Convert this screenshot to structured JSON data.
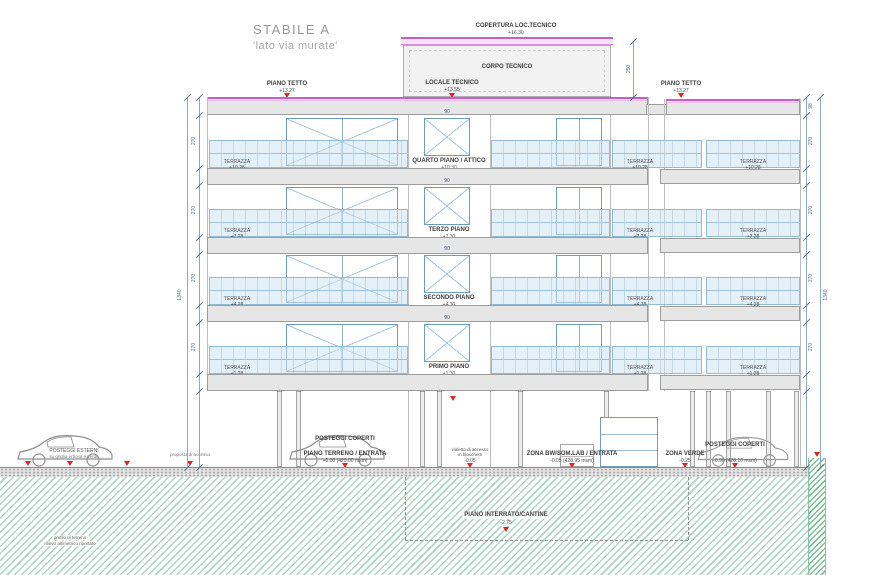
{
  "title": {
    "main": "STABILE A",
    "subtitle": "'lato via murate'"
  },
  "roof": {
    "copertura_label": "COPERTURA LOC.TECNICO",
    "copertura_elev": "+16.30",
    "corpo_tecnico_label": "CORPO TECNICO",
    "locale_tecnico_label": "LOCALE TECNICO",
    "locale_tecnico_elev": "+13.55",
    "piano_tetto_label": "PIANO TETTO",
    "piano_tetto_elev": "+13.27"
  },
  "terrazza_label": "TERRAZZA",
  "floors": [
    {
      "name": "QUARTO PIANO / ATTICO",
      "elev": "+10.30",
      "terrazza_elev": "+10.28"
    },
    {
      "name": "TERZO PIANO",
      "elev": "+7.30",
      "terrazza_elev": "+7.28"
    },
    {
      "name": "SECONDO PIANO",
      "elev": "+4.30",
      "terrazza_elev": "+4.28"
    },
    {
      "name": "PRIMO PIANO",
      "elev": "+1.30",
      "terrazza_elev": "+1.28"
    }
  ],
  "ground": {
    "posteggi_esterni_label": "POSTEGGI ESTERNI",
    "posteggi_esterni_sub": "su griglia erbosa e verde",
    "accesso_note": "proposta di accesso",
    "posteggi_coperti_label": "POSTEGGI COPERTI",
    "piano_terreno_label": "PIANO TERRENO / ENTRATA",
    "piano_terreno_elev": "+0.00 (429.00 msm)",
    "vialetto_line1": "vialetto di accesso",
    "vialetto_line2": "in blocchetti",
    "vialetto_elev": "-0.05",
    "zona_bw_label": "ZONA BW/SOM.LAB / ENTRATA",
    "zona_bw_elev": "-0.05 (428.95 msm)",
    "zona_verde_label": "ZONA VERDE",
    "zona_verde_elev": "-0.25",
    "posteggi_coperti_right_label": "POSTEGGI COPERTI",
    "posteggi_coperti_right_elev": "-0.90 (428.10 msm)",
    "piano_interrato_label": "PIANO INTERRATO/CANTINE",
    "piano_interrato_elev": "-2.75",
    "terrain_note_line1": "profilo di terreno",
    "terrain_note_line2": "rilievo altimetrico riportato"
  },
  "dimensions": {
    "overall_height": "1340",
    "floor_height": "270",
    "roof_parapet": "98",
    "corpo_tecnico_height": "250",
    "window_width": "90"
  },
  "colors": {
    "roof_line": "#c85fc8",
    "glass": "#cde4f1",
    "earth_hatch": "#abd6c0",
    "level_marker": "#e02525"
  }
}
